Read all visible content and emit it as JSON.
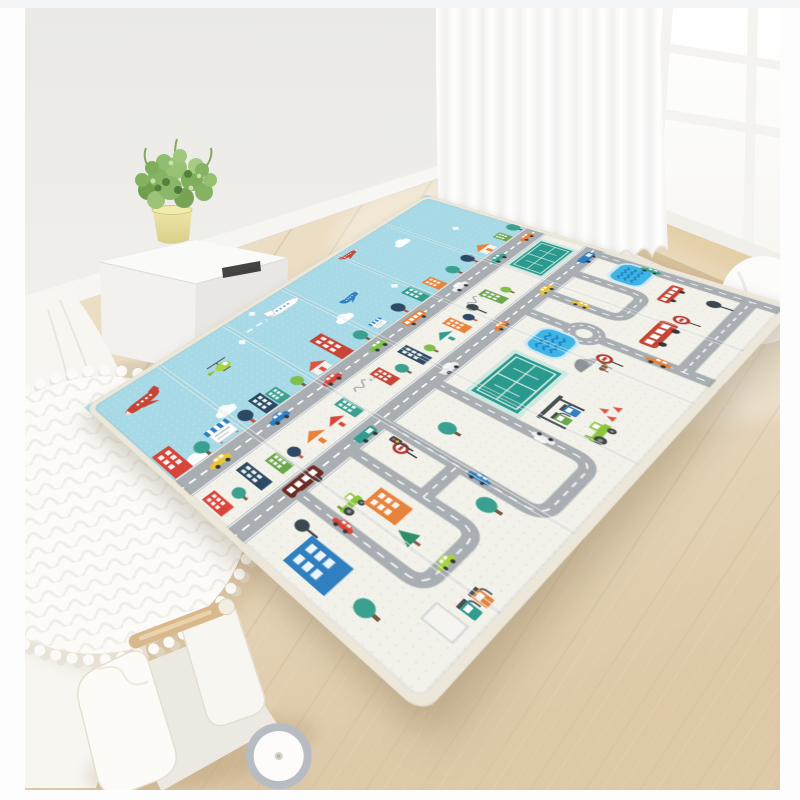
{
  "image": {
    "type": "product-lifestyle-photo",
    "subject": "foldable two-sided baby play mat spread on a light wood floor in a bright nursery",
    "width_px": 800,
    "height_px": 800
  },
  "palette": {
    "page-bg": "#fdfdfe",
    "wall": "#ecebe7",
    "baseboard": "#f6f5f2",
    "floor": "#e7d7bc",
    "floor-seam": "#d2c0a0",
    "window-frame": "#f4f3ef",
    "glass": "#ffffff",
    "curtain": "#fcfcfb",
    "sill-wood": "#e4cfa9",
    "mat-blue": "#a7dae6",
    "mat-cream": "#f2f1ea",
    "mat-edge": "#ece7d9",
    "road": "#a9aeb2",
    "road-dash": "#ffffff",
    "court-green": "#2b9a8e",
    "court-border": "#cfe9e1",
    "pool-blue": "#3fb4e5",
    "pool-wave": "#1a7fc4",
    "bus-red": "#c64535",
    "truck-maroon": "#6e2a22",
    "tractor-green": "#8cc63e",
    "navy": "#2c4a63",
    "teal": "#3aa08f",
    "red": "#e05243",
    "orange": "#e8833c",
    "yellow": "#ecc437",
    "lime": "#a8d441",
    "wood-toy": "#d9b98c",
    "pot-yellow": "#e6df9e",
    "plant-green": "#86b363",
    "wheel-gray": "#b7bcc2"
  },
  "room": {
    "wall": "plain warm-white wall",
    "floor": "light oak laminate planks laid diagonally",
    "window": {
      "frame_color": "white",
      "panes_visible": 6,
      "style": "grid muntin door/window, top right"
    },
    "curtain": "sheer white floor-length curtain, center top",
    "furniture": [
      {
        "name": "white-cube-stool",
        "detail": "white storage cube with black slot handle"
      },
      {
        "name": "potted-plant",
        "detail": "green shrub in pale yellow pot on the cube"
      },
      {
        "name": "pompom-rug",
        "detail": "round white quilted rug with pompom trim, left edge"
      },
      {
        "name": "teepee-fabric",
        "detail": "white canvas and wooden pole, far left"
      },
      {
        "name": "toy-walker",
        "detail": "cream wooden push walker with dowel handle and gray-rimmed wheel, bottom left"
      }
    ]
  },
  "mat": {
    "type": "XPE foldable baby play mat",
    "fold_panels": 6,
    "sections": [
      {
        "name": "sky-airfield",
        "background": "light blue",
        "items": [
          "large red airplane",
          "white outline airplane with contrail",
          "small red airplane",
          "blue airplane",
          "green helicopter",
          "white clouds",
          "diamond sparkles",
          "city skyline row",
          "edge road with cars",
          "orange bus",
          "taxi",
          "trees"
        ]
      },
      {
        "name": "town-road-map",
        "background": "cream white",
        "items": [
          "looping gray roads with dashed centerlines",
          "roundabout",
          "tennis court",
          "swimming pool with waves",
          "red bus",
          "second tennis court",
          "second pool",
          "second red bus",
          "maroon shuttle bus",
          "gas station pumps",
          "green tractor",
          "apartment buildings",
          "houses",
          "round trees",
          "dark lollipop trees",
          "pine tree",
          "ring road signs",
          "traffic light",
          "rock pile",
          "cones",
          "small dog",
          "brand squiggle marks",
          "assorted cars"
        ]
      }
    ]
  }
}
